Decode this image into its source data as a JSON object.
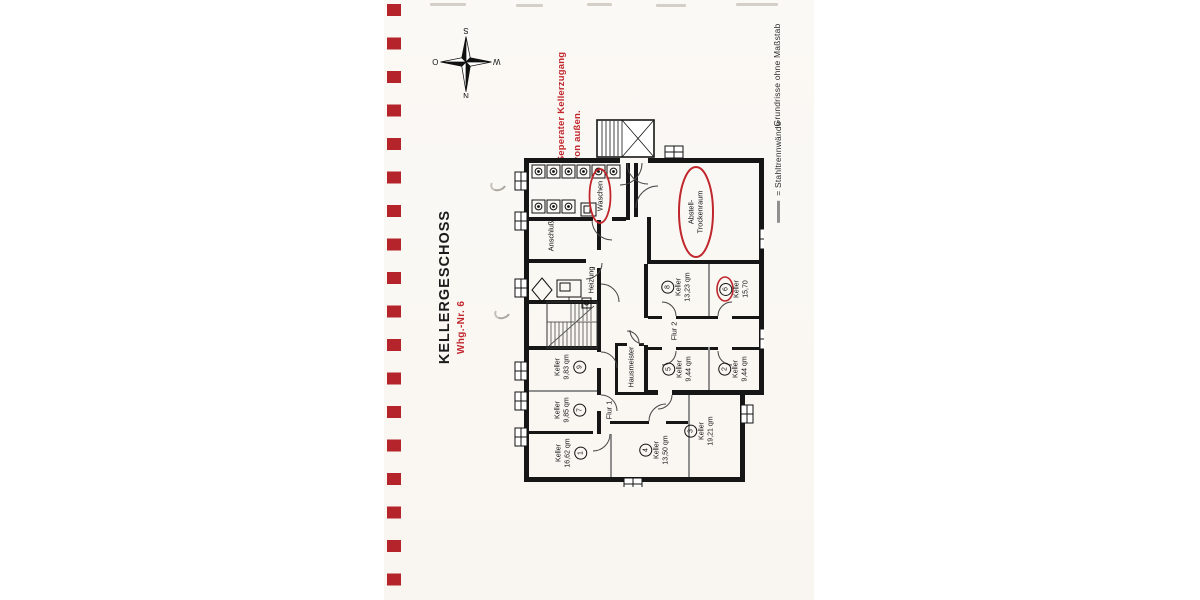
{
  "sheet": {
    "title": "KELLERGESCHOSS",
    "apartment": "Whg.-Nr. 6",
    "note_line1": "Seperater Kellerzugang",
    "note_line2": "von außen.",
    "legend_no_scale": "Grundrisse ohne Maßstab",
    "legend_steel_walls": "= Stahltrennwände",
    "compass": {
      "north": "N",
      "east": "O",
      "south": "S",
      "west": "W"
    }
  },
  "plan": {
    "keller_word": "Keller",
    "rooms": {
      "waschen": "Waschen",
      "abstell_line1": "Abstell-",
      "abstell_line2": "Trockenraum",
      "anschluss": "Anschluß",
      "heizung": "Heizung",
      "hausmeister": "Hausmeister",
      "flur1": "Flur 1",
      "flur2": "Flur 2"
    },
    "cellars": [
      {
        "no": "1",
        "area": "16,62 qm"
      },
      {
        "no": "2",
        "area": "9,44 qm"
      },
      {
        "no": "3",
        "area": "19,21 qm"
      },
      {
        "no": "4",
        "area": "13,50 qm"
      },
      {
        "no": "5",
        "area": "9,44 qm"
      },
      {
        "no": "6",
        "area": "15,70"
      },
      {
        "no": "7",
        "area": "9,85 qm"
      },
      {
        "no": "8",
        "area": "13,23 qm"
      },
      {
        "no": "9",
        "area": "9,83 qm"
      }
    ]
  }
}
